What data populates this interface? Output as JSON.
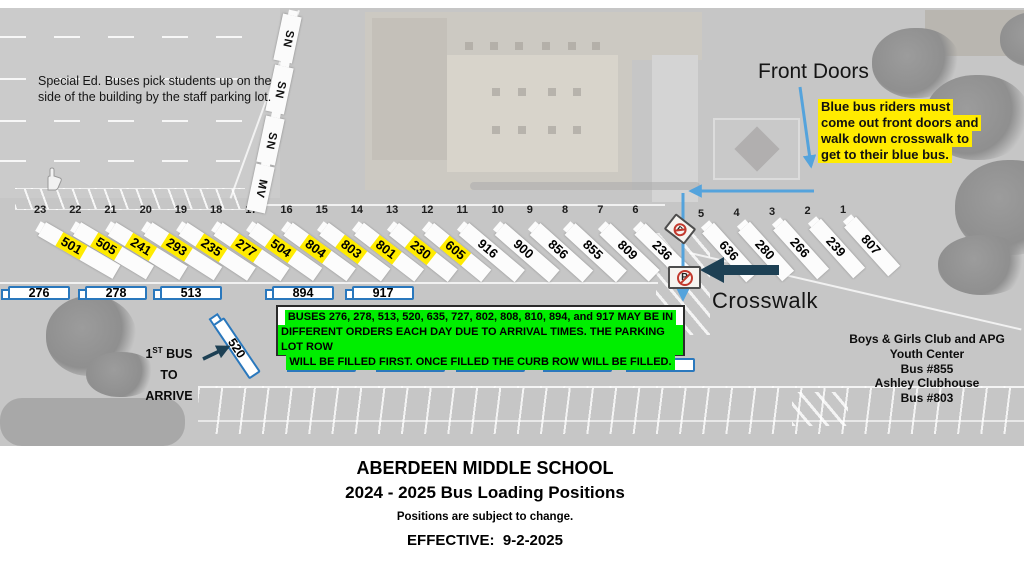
{
  "titles": {
    "school": "ABERDEEN MIDDLE SCHOOL",
    "subtitle": "2024 - 2025 Bus Loading Positions",
    "disclaimer": "Positions are subject to change.",
    "effective": "EFFECTIVE:  9-2-2025"
  },
  "labels": {
    "front_doors": "Front Doors",
    "crosswalk": "Crosswalk",
    "club": [
      "Boys & Girls Club and APG",
      "Youth Center",
      "Bus #855"
    ],
    "ashley": [
      "Ashley Clubhouse",
      "Bus  #803"
    ]
  },
  "notes": {
    "special_ed": "Special Ed. Buses pick students up on the side of the building by the staff parking lot.",
    "blue_bus": [
      "Blue bus riders must",
      "come out front doors and",
      "walk down crosswalk to",
      "get to their blue bus."
    ],
    "green_box": [
      "BUSES 276, 278, 513, 520, 635, 727, 802, 808, 810, 894, and 917 MAY BE IN",
      "DIFFERENT ORDERS EACH DAY DUE TO ARRIVAL TIMES. THE PARKING LOT ROW",
      "WILL BE FILLED FIRST. ONCE FILLED THE CURB ROW WILL BE FILLED."
    ]
  },
  "first_bus": {
    "num": "1",
    "sup": "ST",
    "rest": " BUS",
    "to": "TO",
    "arrive": "ARRIVE"
  },
  "side_buses": [
    "SN",
    "SN",
    "SN",
    "MV"
  ],
  "curb_slots": [
    {
      "stall": "23",
      "bus": "501",
      "highlight": true
    },
    {
      "stall": "22",
      "bus": "505",
      "highlight": true
    },
    {
      "stall": "21",
      "bus": "241",
      "highlight": true
    },
    {
      "stall": "20",
      "bus": "293",
      "highlight": true
    },
    {
      "stall": "19",
      "bus": "235",
      "highlight": true
    },
    {
      "stall": "18",
      "bus": "277",
      "highlight": true
    },
    {
      "stall": "17",
      "bus": "504",
      "highlight": true
    },
    {
      "stall": "16",
      "bus": "804",
      "highlight": true
    },
    {
      "stall": "15",
      "bus": "803",
      "highlight": true
    },
    {
      "stall": "14",
      "bus": "801",
      "highlight": true
    },
    {
      "stall": "13",
      "bus": "230",
      "highlight": true
    },
    {
      "stall": "12",
      "bus": "605",
      "highlight": true
    },
    {
      "stall": "11",
      "bus": "916",
      "highlight": false
    },
    {
      "stall": "10",
      "bus": "900",
      "highlight": false
    },
    {
      "stall": "9",
      "bus": "856",
      "highlight": false
    },
    {
      "stall": "8",
      "bus": "855",
      "highlight": false
    },
    {
      "stall": "7",
      "bus": "809",
      "highlight": false
    },
    {
      "stall": "6",
      "bus": "236",
      "highlight": false
    }
  ],
  "front_slots": [
    {
      "stall": "5",
      "bus": "636",
      "highlight": false
    },
    {
      "stall": "4",
      "bus": "280",
      "highlight": false
    },
    {
      "stall": "3",
      "bus": "266",
      "highlight": false
    },
    {
      "stall": "2",
      "bus": "239",
      "highlight": false
    },
    {
      "stall": "1",
      "bus": "807",
      "highlight": false
    }
  ],
  "parking_row": [
    "276",
    "278",
    "513",
    "894",
    "917"
  ],
  "curb_row": [
    "635",
    "727",
    "802",
    "808",
    "810"
  ],
  "diagonal_bus": "520",
  "signs": {
    "letter": "P"
  },
  "colors": {
    "highlight_yellow": "#ffeb00",
    "highlight_green": "#00ee00",
    "bus_outline_blue": "#2a78bd",
    "arrow_blue": "#54a3dc",
    "arrow_dark": "#1d4054",
    "sign_red": "#c23a2e"
  }
}
